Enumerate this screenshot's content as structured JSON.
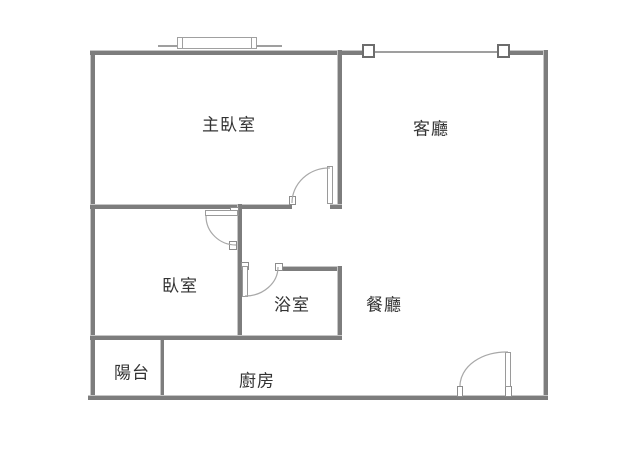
{
  "app": {
    "type": "apartment-floor-plan"
  },
  "rooms": [
    {
      "id": "master-bedroom",
      "label": "主臥室"
    },
    {
      "id": "living-room",
      "label": "客廳"
    },
    {
      "id": "bedroom",
      "label": "臥室"
    },
    {
      "id": "bathroom",
      "label": "浴室"
    },
    {
      "id": "dining-room",
      "label": "餐廳"
    },
    {
      "id": "balcony",
      "label": "陽台"
    },
    {
      "id": "kitchen",
      "label": "廚房"
    }
  ],
  "symbols": {
    "doors": [
      "master-bedroom-door-swing",
      "bedroom-door-swing",
      "bathroom-door-swing",
      "entrance-door-swing"
    ],
    "windows": [
      "living-room-window-line",
      "master-bedroom-bay-window"
    ],
    "columns": [
      "column-left",
      "column-right"
    ]
  },
  "colors": {
    "wall": "#7d7d7d",
    "thin_line": "#9f9f9f",
    "door_arc": "#a8a8a8",
    "text": "#333333",
    "background": "#ffffff"
  }
}
